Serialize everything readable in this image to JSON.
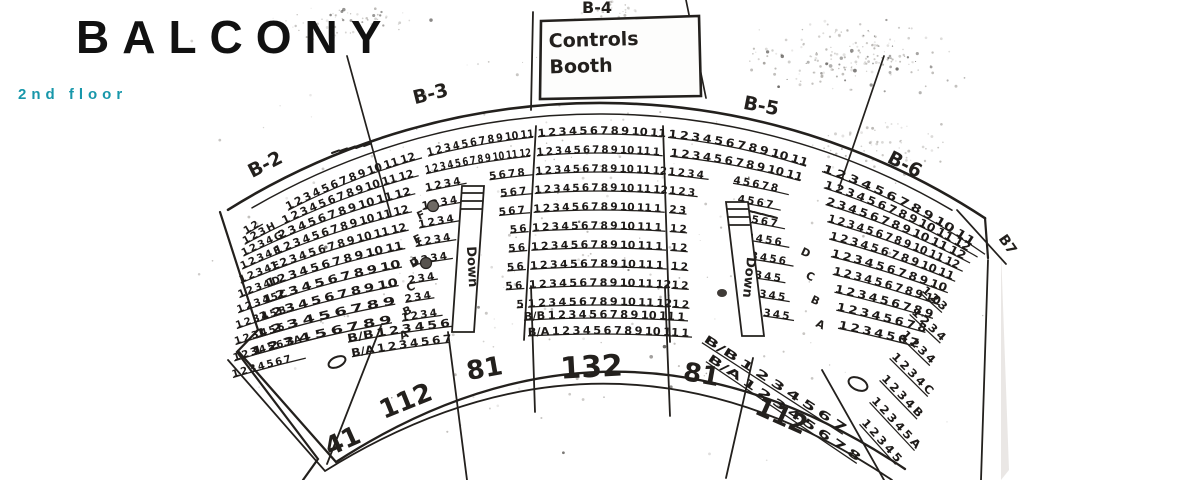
{
  "page": {
    "title": "BALCONY",
    "subtitle": "2nd floor"
  },
  "colors": {
    "accent": "#1797aa",
    "ink": "#23201d",
    "paper": "#ffffff"
  },
  "booth": {
    "label": "B-4",
    "line1": "Controls",
    "line2": "Booth"
  },
  "section_labels": [
    "B-2",
    "B-3",
    "B-5",
    "B-6",
    "B7"
  ],
  "stairs_label": "Down",
  "capacities": [
    "41",
    "112",
    "81",
    "132",
    "81",
    "112"
  ],
  "seating": {
    "left_block": {
      "rows": [
        "1 2",
        "1 2 3 H",
        "1 2 3 4 G",
        "1 2 3 4 F",
        "1 2 3 4 E",
        "1 2 3 4 D",
        "1 2 3 4 5 C",
        "1 2 3 4 5 B",
        "1 2 3 4 5 6",
        "1 2 3 4 5 6 7 A",
        "1 2 3 4 5 6 7"
      ]
    },
    "b2": {
      "rows": [
        "1 2 3 4 5 6 7 8 9 10 11 12",
        "1 2 3 4 5 6 7 8 9 10 11 12",
        "2 3 4 5 6 7 8 9 10 11 12",
        "1 2 3 4 5 6 7 8 9 10 11 12",
        "1 2 3 4 5 6 7 8 9 10 11 12",
        "1 2 3 4 5 6 7 8 9 10 11",
        "1 2 3 4 5 6 7 8 9 10",
        "1 2 3 4 5 6 7 8 9 10",
        "1 2 3 4 5 6 7 8 9",
        "1 2 3 4 5 6 7 8 9"
      ]
    },
    "b3": {
      "full_rows": [
        "1 2 3 4 5 6 7 8 9 10 11",
        "1 2 3 4 5 6 7 8 9 10 11 12"
      ],
      "left_rows": [
        "1 2 3 4",
        "1 2 3 4",
        "1 2 3 4",
        "1 2 3 4",
        "1 2 3 4",
        "2 3 4",
        "2 3 4",
        "1 2 3 4"
      ],
      "right_rows": [
        "5 6 7 8",
        "5 6 7",
        "5 6 7",
        "5 6",
        "5 6",
        "5 6",
        "5 6",
        "5"
      ]
    },
    "b4": {
      "rows": [
        "1 2 3 4 5 6 7 8 9 10 11",
        "1 2 3 4 5 6 7 8 9 10 11 12",
        "1 2 3 4 5 6 7 8 9 10 11 12",
        "1 2 3 4 5 6 7 8 9 10 11 12",
        "1 2 3 4 5 6 7 8 9 10 11 12",
        "1 2 3 4 5 6 7 8 9 10 11 12",
        "1 2 3 4 5 6 7 8 9 10 11 12",
        "1 2 3 4 5 6 7 8 9 10 11 12",
        "1 2 3 4 5 6 7 8 9 10 11 12",
        "1 2 3 4 5 6 7 8 9 10 11 12"
      ]
    },
    "b5": {
      "full_rows": [
        "1 2 3 4 5 6 7 8 9 10 11",
        "1 2 3 4 5 6 7 8 9 10 11"
      ],
      "left_rows": [
        "1 2 3 4",
        "1 2 3",
        "2 3",
        "1 2",
        "1 2",
        "1 2",
        "1 2",
        "1 2"
      ],
      "right_rows": [
        "4 5 6 7 8",
        "4 5 6 7",
        "4 5 6 7",
        "3 4 5 6",
        "3 4 5 6",
        "3 4 5",
        "3 4 5",
        "3 4 5"
      ]
    },
    "b6": {
      "rows": [
        "1 2 3 4 5 6 7 8 9 10 11",
        "1 2 3 4 5 6 7 8 9 10 11 12",
        "2 3 4 5 6 7 8 9 10 11 12",
        "1 2 3 4 5 6 7 8 9 10 11 12",
        "1 2 3 4 5 6 7 8 9 10 11",
        "1 2 3 4 5 6 7 8 9 10",
        "1 2 3 4 5 6 7 8 9 10",
        "1 2 3 4 5 6 7 8 9",
        "1 2 3 4 5 6 7 8",
        "1 2 3 4 5 6 7"
      ]
    },
    "right_block": {
      "rows": [
        "1 2 3",
        "1 2 3 4",
        "1 2 3 4",
        "1 2 3 4 C",
        "1 2 3 4 B",
        "1 2 3 4 5 A",
        "1 2 3 4 5"
      ]
    },
    "front": {
      "bb_left": "B/B 1 2 3 4 5 6 7 8",
      "ba_left": "B/A 1 2 3 4 5 6 7",
      "bb_center": "B/B 1 2 3 4 5 6 7 8 9 10 11 12",
      "ba_center": "B/A 1 2 3 4 5 6 7 8 9 10 11 12",
      "bb_right": "B/B 1 2 3 4 5 6 7",
      "ba_right": "B/A 1 2 3 4 5 6 7 8"
    },
    "aisle_letters_mid": [
      "F",
      "E",
      "D",
      "C",
      "B",
      "A"
    ],
    "aisle_letters_right": [
      "D",
      "C",
      "B",
      "A"
    ]
  }
}
